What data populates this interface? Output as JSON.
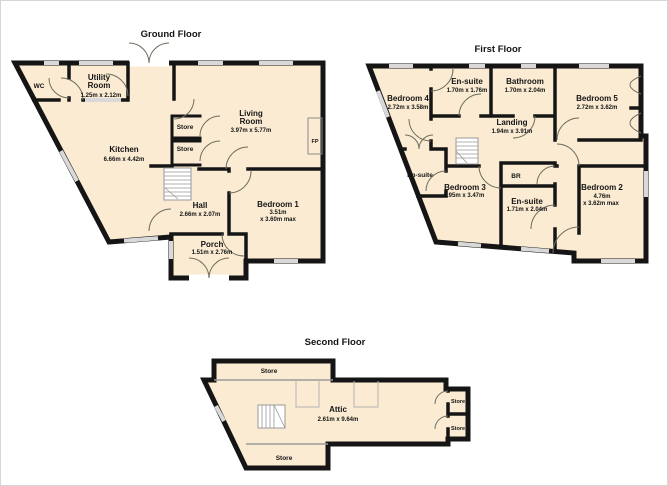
{
  "colors": {
    "room_fill": "#FAEBD2",
    "wall": "#151515",
    "window": "#D9D9D9",
    "door_arc": "#6F6F5F"
  },
  "floors": {
    "ground": {
      "title": "Ground Floor",
      "rooms": {
        "wc": {
          "name": "WC"
        },
        "utility": {
          "line1": "Utility",
          "line2": "Room",
          "dims": "1.25m x 2.12m"
        },
        "kitchen": {
          "name": "Kitchen",
          "dims": "6.66m x 4.42m"
        },
        "living": {
          "line1": "Living",
          "line2": "Room",
          "dims": "3.97m x 5.77m"
        },
        "store1": {
          "name": "Store"
        },
        "store2": {
          "name": "Store"
        },
        "hall": {
          "name": "Hall",
          "dims": "2.66m x 2.07m"
        },
        "bedroom1": {
          "name": "Bedroom 1",
          "dim1": "3.51m",
          "dim2": "x 3.60m max"
        },
        "porch": {
          "name": "Porch",
          "dims": "1.51m x 2.76m"
        },
        "fp": {
          "name": "FP"
        }
      }
    },
    "first": {
      "title": "First Floor",
      "rooms": {
        "bedroom4": {
          "name": "Bedroom 4",
          "dims": "2.72m x 3.58m"
        },
        "ensuite_top": {
          "name": "En-suite",
          "dims": "1.70m x 1.76m"
        },
        "bathroom": {
          "name": "Bathroom",
          "dims": "1.70m x 2.04m"
        },
        "bedroom5": {
          "name": "Bedroom 5",
          "dims": "2.72m x 3.62m"
        },
        "landing": {
          "name": "Landing",
          "dims": "1.94m x 3.91m"
        },
        "ensuite_left": {
          "name": "En-suite"
        },
        "bedroom3": {
          "name": "Bedroom 3",
          "dims": "2.95m x 3.47m"
        },
        "br": {
          "name": "BR"
        },
        "ensuite_mid": {
          "name": "En-suite",
          "dims": "1.71m x 2.04m"
        },
        "bedroom2": {
          "name": "Bedroom 2",
          "dim1": "4.76m",
          "dim2": "x 3.62m max"
        }
      }
    },
    "second": {
      "title": "Second Floor",
      "rooms": {
        "attic": {
          "name": "Attic",
          "dims": "2.61m x 9.64m"
        },
        "store_top": {
          "name": "Store"
        },
        "store_bottom": {
          "name": "Store"
        },
        "store_right1": {
          "name": "Store"
        },
        "store_right2": {
          "name": "Store"
        }
      }
    }
  }
}
